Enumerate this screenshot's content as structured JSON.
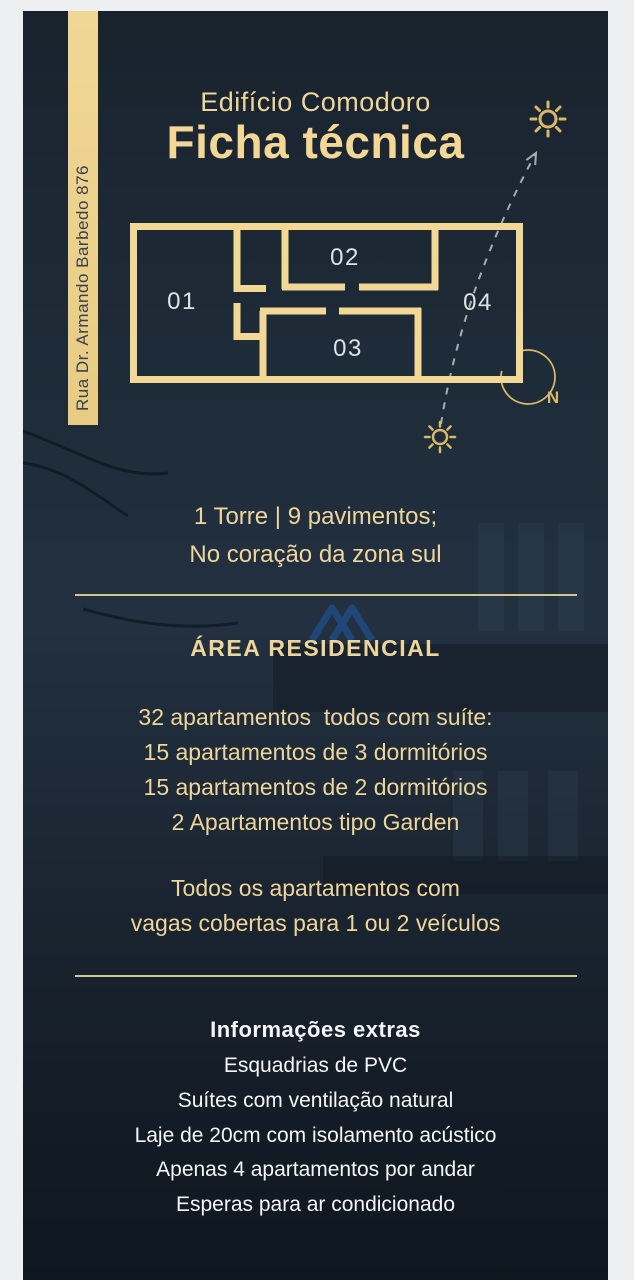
{
  "colors": {
    "background_navy": "#1d2935",
    "frame_gray": "#eeeff1",
    "gold_text": "#eed59a",
    "gold_title": "#f2d795",
    "gold_strip": "#ecd08c",
    "divider_gold": "#d4c78d",
    "sun_gold": "#d9b868",
    "white_text": "#f4f6f7",
    "plan_label_gray": "#dde2e4",
    "dash_gray": "#a7aeac",
    "watermark_blue": "#1e5aa8",
    "banner_text_navy": "#39414c"
  },
  "banner": {
    "address": "Rua Dr. Armando Barbedo 876"
  },
  "header": {
    "subtitle": "Edifício Comodoro",
    "title": "Ficha técnica"
  },
  "floor_plan": {
    "units": [
      {
        "label": "01"
      },
      {
        "label": "02"
      },
      {
        "label": "03"
      },
      {
        "label": "04"
      }
    ],
    "compass_label": "N"
  },
  "tower_info": {
    "line1": "1 Torre | 9 pavimentos;",
    "line2": "No coração da zona sul"
  },
  "residential": {
    "heading": "ÁREA RESIDENCIAL",
    "items": [
      "32 apartamentos  todos com suíte:",
      "15 apartamentos de 3 dormitórios",
      "15 apartamentos de 2 dormitórios",
      "2 Apartamentos tipo Garden"
    ],
    "parking_line1": "Todos os apartamentos com",
    "parking_line2": "vagas cobertas para 1 ou 2 veículos"
  },
  "extras": {
    "heading": "Informações extras",
    "items": [
      "Esquadrias de PVC",
      "Suítes com ventilação natural",
      "Laje de 20cm com isolamento acústico",
      "Apenas 4 apartamentos por andar",
      "Esperas para ar condicionado"
    ]
  }
}
